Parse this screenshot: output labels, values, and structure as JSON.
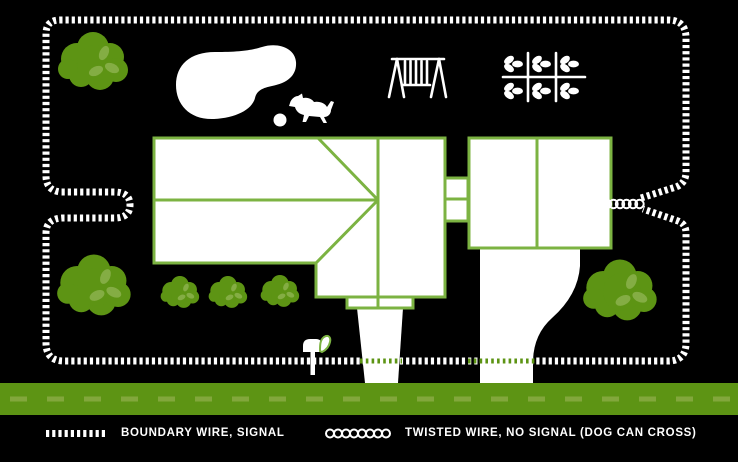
{
  "colors": {
    "background": "#000000",
    "map_green": "#5d9414",
    "outline_green": "#7cb342",
    "leaf_green": "#84ad44",
    "road_dash_green": "#82a73c",
    "white": "#ffffff"
  },
  "legend": {
    "boundary_label": "BOUNDARY WIRE, SIGNAL",
    "twisted_label": "TWISTED WIRE, NO SIGNAL (DOG CAN CROSS)"
  }
}
